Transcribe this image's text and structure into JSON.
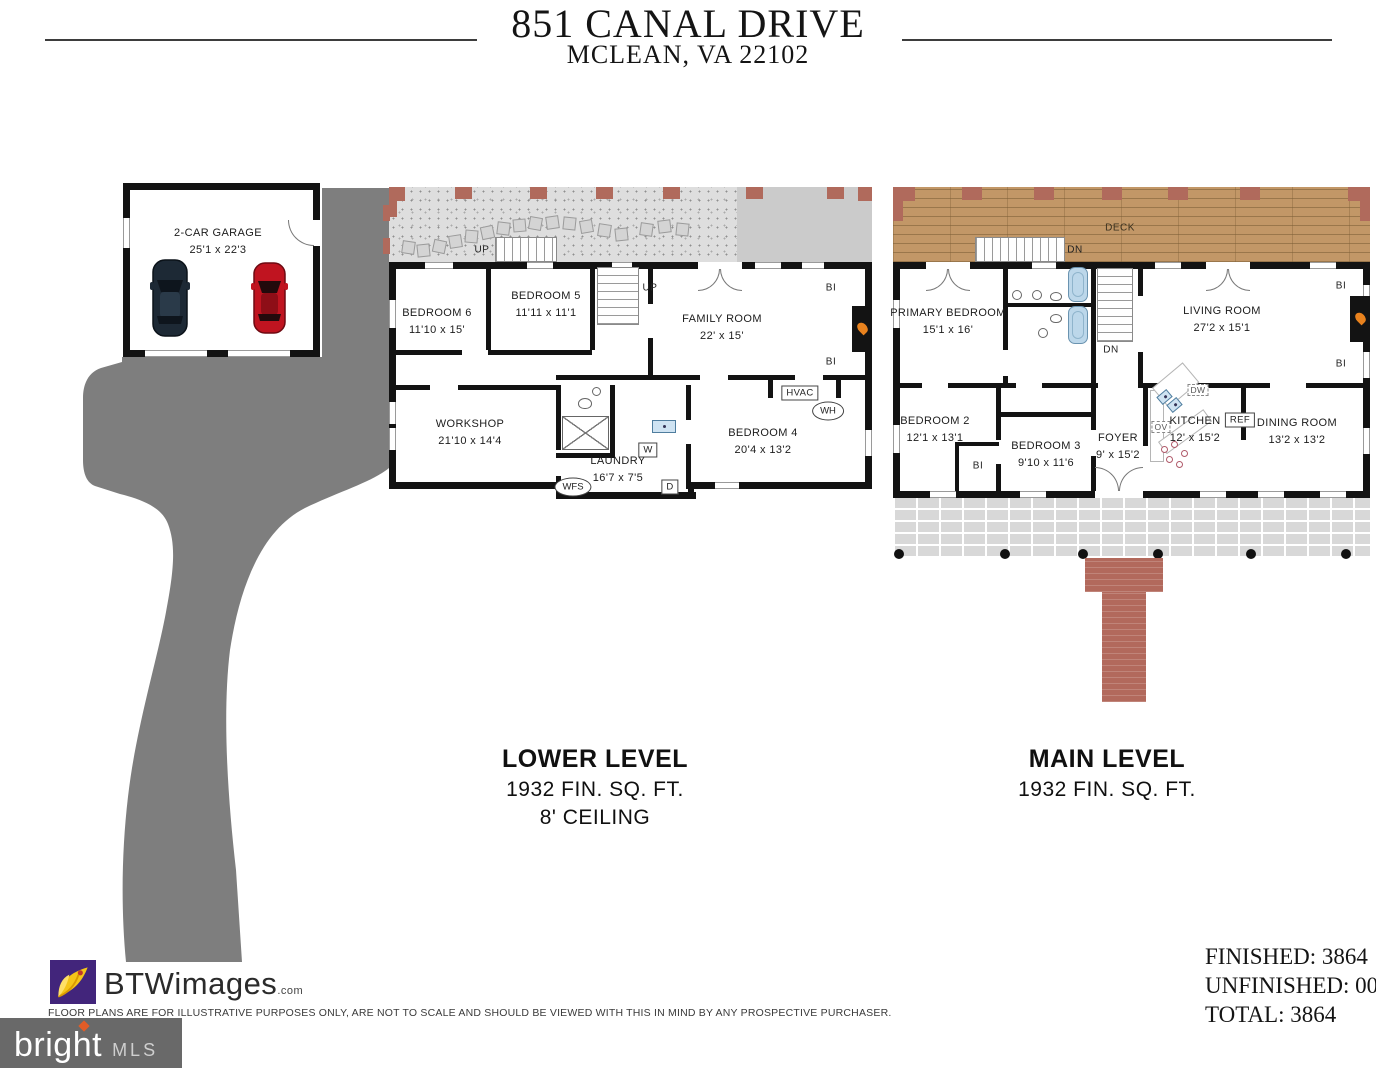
{
  "header": {
    "address": "851 CANAL DRIVE",
    "city": "MCLEAN, VA 22102"
  },
  "garage": {
    "name": "2-CAR GARAGE",
    "dims": "25'1 x 22'3"
  },
  "lower_level": {
    "title": "LOWER LEVEL",
    "area": "1932 FIN. SQ. FT.",
    "ceiling": "8' CEILING",
    "rooms": [
      {
        "name": "BEDROOM 6",
        "dims": "11'10 x 15'"
      },
      {
        "name": "BEDROOM 5",
        "dims": "11'11 x 11'1"
      },
      {
        "name": "FAMILY ROOM",
        "dims": "22' x 15'"
      },
      {
        "name": "WORKSHOP",
        "dims": "21'10 x 14'4"
      },
      {
        "name": "LAUNDRY",
        "dims": "16'7 x 7'5"
      },
      {
        "name": "BEDROOM 4",
        "dims": "20'4 x 13'2"
      }
    ],
    "labels": {
      "up_exterior": "UP",
      "up_interior": "UP",
      "hvac": "HVAC",
      "wh": "WH",
      "w": "W",
      "d": "D",
      "wfs": "WFS",
      "bi": "BI"
    }
  },
  "main_level": {
    "title": "MAIN LEVEL",
    "area": "1932 FIN. SQ. FT.",
    "deck": "DECK",
    "rooms": [
      {
        "name": "PRIMARY BEDROOM",
        "dims": "15'1 x 16'"
      },
      {
        "name": "LIVING ROOM",
        "dims": "27'2 x 15'1"
      },
      {
        "name": "BEDROOM 2",
        "dims": "12'1 x 13'1"
      },
      {
        "name": "BEDROOM 3",
        "dims": "9'10 x 11'6"
      },
      {
        "name": "FOYER",
        "dims": "9' x 15'2"
      },
      {
        "name": "KITCHEN",
        "dims": "12' x 15'2"
      },
      {
        "name": "DINING ROOM",
        "dims": "13'2 x 13'2"
      }
    ],
    "labels": {
      "dn_deck": "DN",
      "dn_interior": "DN",
      "dw": "DW",
      "ov": "OV",
      "ref": "REF",
      "bi": "BI"
    }
  },
  "footer": {
    "brand": "BTWimages",
    "brand_suffix": ".com",
    "disclaimer": "FLOOR PLANS ARE FOR ILLUSTRATIVE PURPOSES ONLY, ARE NOT TO SCALE AND SHOULD BE VIEWED WITH THIS IN MIND BY ANY PROSPECTIVE PURCHASER.",
    "mls_brand": "bright",
    "mls_tm": "TM",
    "mls_suffix": "MLS",
    "finished": "FINISHED: 3864",
    "unfinished": "UNFINISHED: 000",
    "total": "TOTAL: 3864"
  },
  "colors": {
    "driveway": "#7e7e7e",
    "deck_wood": "#c29767",
    "brick": "#b06a5c",
    "wall": "#131313",
    "tub": "#bcd7ea",
    "flame": "#e8821e",
    "patio": "#dedede",
    "porch": "#d8d8d8",
    "mls_gray": "#696969",
    "btw_purple": "#42257b",
    "btw_yellow": "#f5c518"
  }
}
